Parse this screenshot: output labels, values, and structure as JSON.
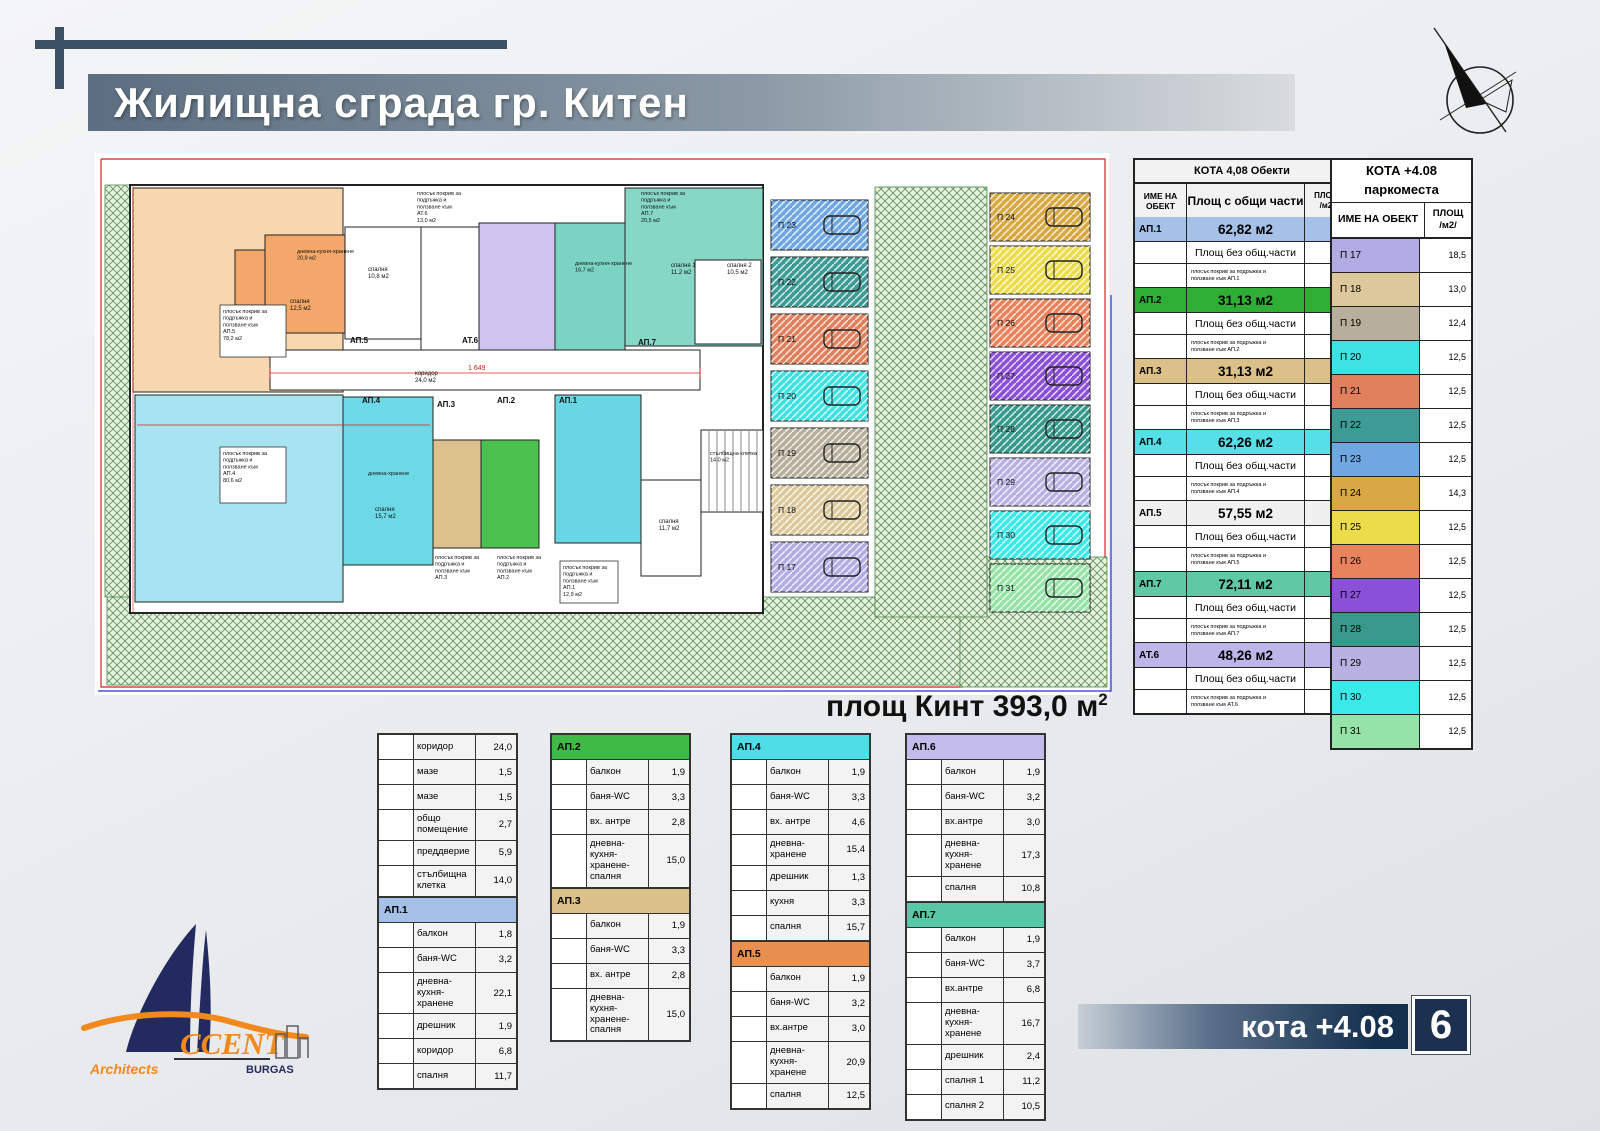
{
  "header": {
    "title": "Жилищна сграда гр. Китен"
  },
  "plot_area": {
    "text": "площ Кинт 393,0 м",
    "sup": "2"
  },
  "footer": {
    "kota": "кота +4.08",
    "sheet": "6"
  },
  "logo": {
    "ccent": "CCENT",
    "architects": "Architects",
    "city": "BURGAS"
  },
  "objects_table": {
    "title": "КОТА 4,08 Обекти",
    "headers": {
      "name": "ИМЕ НА ОБЕКТ",
      "with_common": "Площ с общи части",
      "area1": "ПЛОЩ",
      "area2": "/м2/"
    },
    "net_label": "Площ без общ.части",
    "rows": [
      {
        "name": "АП.1",
        "color": "#a6c1e8",
        "total": "62,82 м2",
        "net": "56,1",
        "roof_note": "плосък покрив за подръжка и\nползване към АП.1",
        "roof": "12,9"
      },
      {
        "name": "АП.2",
        "color": "#2fae35",
        "total": "31,13 м2",
        "net": "27,8",
        "roof_note": "плосък покрив за подръжка и\nползване към  АП.2",
        "roof": "6,2"
      },
      {
        "name": "АП.3",
        "color": "#dcc08a",
        "total": "31,13 м2",
        "net": "27,8",
        "roof_note": "плосък покрив за подръжка и\nползване към  АП.3",
        "roof": "6,2"
      },
      {
        "name": "АП.4",
        "color": "#57dfe8",
        "total": "62,26 м2",
        "net": "55,6",
        "roof_note": "плосък покрив за подръжка и\nползване към  АП.4",
        "roof": "80,6"
      },
      {
        "name": "АП.5",
        "color": "#f0f0f0",
        "total": "57,55 м2",
        "net": "51,4",
        "roof_note": "плосък покрив за подръжка и\nползване към  АП.5",
        "roof": "79,2"
      },
      {
        "name": "АП.7",
        "color": "#5fc9a5",
        "total": "72,11 м2",
        "net": "64,4",
        "roof_note": "плосък покрив за подръжка и\nползване към  АП.7",
        "roof": "20,5"
      },
      {
        "name": "АТ.6",
        "color": "#beb5e8",
        "total": "48,26 м2",
        "net": "43,1",
        "roof_note": "плосък покрив за подръжка и\nползване към  АТ.6",
        "roof": "13,0"
      }
    ]
  },
  "parking_table": {
    "title_line1": "КОТА +4.08",
    "title_line2": "паркоместа",
    "headers": {
      "name": "ИМЕ НА ОБЕКТ",
      "area1": "ПЛОЩ",
      "area2": "/м2/"
    },
    "rows": [
      {
        "name": "П 17",
        "area": "18,5",
        "color": "#b3abe4"
      },
      {
        "name": "П 18",
        "area": "13,0",
        "color": "#ddc89c"
      },
      {
        "name": "П 19",
        "area": "12,4",
        "color": "#b7af9b"
      },
      {
        "name": "П 20",
        "area": "12,5",
        "color": "#3fe2e2"
      },
      {
        "name": "П 21",
        "area": "12,5",
        "color": "#e0805c"
      },
      {
        "name": "П 22",
        "area": "12,5",
        "color": "#3c9b95"
      },
      {
        "name": "П 23",
        "area": "12,5",
        "color": "#6fa7e2"
      },
      {
        "name": "П 24",
        "area": "14,3",
        "color": "#d8a842"
      },
      {
        "name": "П 25",
        "area": "12,5",
        "color": "#ecdc4c"
      },
      {
        "name": "П 26",
        "area": "12,5",
        "color": "#e8835d"
      },
      {
        "name": "П 27",
        "area": "12,5",
        "color": "#8b50d8"
      },
      {
        "name": "П 28",
        "area": "12,5",
        "color": "#37998c"
      },
      {
        "name": "П 29",
        "area": "12,5",
        "color": "#b9b1e2"
      },
      {
        "name": "П 30",
        "area": "12,5",
        "color": "#3ce9e9"
      },
      {
        "name": "П 31",
        "area": "12,5",
        "color": "#96e3a7"
      }
    ]
  },
  "room_tables": [
    {
      "blocks": [
        {
          "header": null,
          "color": null,
          "rows": [
            [
              "коридор",
              "24,0"
            ],
            [
              "мазе",
              "1,5"
            ],
            [
              "мазе",
              "1,5"
            ],
            [
              "общо помещение",
              "2,7"
            ],
            [
              "преддверие",
              "5,9"
            ],
            [
              "стълбищна клетка",
              "14,0"
            ]
          ]
        },
        {
          "header": "АП.1",
          "color": "#a6c1e8",
          "rows": [
            [
              "балкон",
              "1,8"
            ],
            [
              "баня-WC",
              "3,2"
            ],
            [
              "дневна-кухня-хранене",
              "22,1"
            ],
            [
              "дрешник",
              "1,9"
            ],
            [
              "коридор",
              "6,8"
            ],
            [
              "спалня",
              "11,7"
            ]
          ]
        }
      ]
    },
    {
      "blocks": [
        {
          "header": "АП.2",
          "color": "#3fbb45",
          "rows": [
            [
              "балкон",
              "1,9"
            ],
            [
              "баня-WC",
              "3,3"
            ],
            [
              "вх. антре",
              "2,8"
            ],
            [
              "дневна-кухня-хранене-спалня",
              "15,0"
            ]
          ]
        },
        {
          "header": "АП.3",
          "color": "#dcc08a",
          "rows": [
            [
              "балкон",
              "1,9"
            ],
            [
              "баня-WC",
              "3,3"
            ],
            [
              "вх. антре",
              "2,8"
            ],
            [
              "дневна-кухня-хранене-спалня",
              "15,0"
            ]
          ]
        }
      ]
    },
    {
      "blocks": [
        {
          "header": "АП.4",
          "color": "#4fdde8",
          "rows": [
            [
              "балкон",
              "1,9"
            ],
            [
              "баня-WC",
              "3,3"
            ],
            [
              "вх. антре",
              "4,6"
            ],
            [
              "дневна-хранене",
              "15,4"
            ],
            [
              "дрешник",
              "1,3"
            ],
            [
              "кухня",
              "3,3"
            ],
            [
              "спалня",
              "15,7"
            ]
          ]
        },
        {
          "header": "АП.5",
          "color": "#e89050",
          "rows": [
            [
              "балкон",
              "1,9"
            ],
            [
              "баня-WC",
              "3,2"
            ],
            [
              "вх.антре",
              "3,0"
            ],
            [
              "дневна-кухня-хранене",
              "20,9"
            ],
            [
              "спалня",
              "12,5"
            ]
          ]
        }
      ]
    },
    {
      "blocks": [
        {
          "header": "АП.6",
          "color": "#c3bbe9",
          "rows": [
            [
              "балкон",
              "1,9"
            ],
            [
              "баня-WC",
              "3,2"
            ],
            [
              "вх.антре",
              "3,0"
            ],
            [
              "дневна-кухня-хранене",
              "17,3"
            ],
            [
              "спалня",
              "10,8"
            ]
          ]
        },
        {
          "header": "АП.7",
          "color": "#57c8a3",
          "rows": [
            [
              "балкон",
              "1,9"
            ],
            [
              "баня-WC",
              "3,7"
            ],
            [
              "вх.антре",
              "6,8"
            ],
            [
              "дневна-кухня-хранене",
              "16,7"
            ],
            [
              "дрешник",
              "2,4"
            ],
            [
              "спалня 1",
              "11,2"
            ],
            [
              "спалня 2",
              "10,5"
            ]
          ]
        }
      ]
    }
  ],
  "plan": {
    "hatch": [
      {
        "x": 22,
        "y": 452,
        "w": 855,
        "h": 88
      },
      {
        "x": 875,
        "y": 412,
        "w": 147,
        "h": 130
      },
      {
        "x": 790,
        "y": 42,
        "w": 112,
        "h": 430
      },
      {
        "x": 20,
        "y": 40,
        "w": 28,
        "h": 412
      }
    ],
    "rooms": [
      {
        "x": 45,
        "y": 40,
        "w": 633,
        "h": 428,
        "f": "#ffffff",
        "sw": 2
      },
      {
        "x": 48,
        "y": 43,
        "w": 210,
        "h": 204,
        "f": "#f8d7ae"
      },
      {
        "x": 180,
        "y": 90,
        "w": 80,
        "h": 98,
        "f": "#f3a768"
      },
      {
        "x": 150,
        "y": 105,
        "w": 30,
        "h": 55,
        "f": "#f3a768"
      },
      {
        "x": 260,
        "y": 82,
        "w": 76,
        "h": 112,
        "f": "#ffffff"
      },
      {
        "x": 336,
        "y": 82,
        "w": 58,
        "h": 124,
        "f": "#ffffff"
      },
      {
        "x": 394,
        "y": 78,
        "w": 76,
        "h": 128,
        "f": "#cdc4ef"
      },
      {
        "x": 470,
        "y": 78,
        "w": 70,
        "h": 128,
        "f": "#7bd3c3"
      },
      {
        "x": 540,
        "y": 43,
        "w": 138,
        "h": 158,
        "f": "#86d7c6"
      },
      {
        "x": 610,
        "y": 115,
        "w": 66,
        "h": 84,
        "f": "#ffffff"
      },
      {
        "x": 185,
        "y": 205,
        "w": 430,
        "h": 40,
        "f": "#ffffff"
      },
      {
        "x": 50,
        "y": 250,
        "w": 208,
        "h": 207,
        "f": "#a8e4f0"
      },
      {
        "x": 258,
        "y": 252,
        "w": 90,
        "h": 168,
        "f": "#6cd9e7"
      },
      {
        "x": 348,
        "y": 295,
        "w": 48,
        "h": 108,
        "f": "#dcc18c"
      },
      {
        "x": 396,
        "y": 295,
        "w": 58,
        "h": 108,
        "f": "#4cc04f"
      },
      {
        "x": 470,
        "y": 250,
        "w": 86,
        "h": 148,
        "f": "#69d6e4"
      },
      {
        "x": 556,
        "y": 335,
        "w": 60,
        "h": 96,
        "f": "#ffffff"
      },
      {
        "x": 616,
        "y": 285,
        "w": 62,
        "h": 82,
        "f": "#ffffff"
      }
    ],
    "parking_left": {
      "x": 686,
      "y": 55,
      "w": 97,
      "h": 50,
      "pitch": 57,
      "stalls": [
        [
          "П 23",
          "#6fa7e2"
        ],
        [
          "П 22",
          "#3c9b95"
        ],
        [
          "П 21",
          "#e0805c"
        ],
        [
          "П 20",
          "#3fe2e2"
        ],
        [
          "П 19",
          "#b7af9b"
        ],
        [
          "П 18",
          "#ddc89c"
        ],
        [
          "П 17",
          "#b3abe4"
        ]
      ]
    },
    "parking_right": {
      "x": 905,
      "y": 48,
      "w": 100,
      "h": 48,
      "pitch": 53,
      "stalls": [
        [
          "П 24",
          "#d8a842"
        ],
        [
          "П 25",
          "#ecdc4c"
        ],
        [
          "П 26",
          "#e8835d"
        ],
        [
          "П 27",
          "#8b50d8"
        ],
        [
          "П 28",
          "#37998c"
        ],
        [
          "П 29",
          "#b9b1e2"
        ],
        [
          "П 30",
          "#3ce9e9"
        ],
        [
          "П 31",
          "#96e3a7"
        ]
      ]
    },
    "labels": [
      {
        "x": 138,
        "y": 168,
        "w": 66,
        "h": 52,
        "box": 1,
        "s": 5.5,
        "t": "плосък покрив за\nподръжка и\nползване към\nАП.5\n78,2 м2"
      },
      {
        "x": 138,
        "y": 310,
        "w": 66,
        "h": 56,
        "box": 1,
        "s": 5.5,
        "t": "плосък покрив за\nподръжка и\nползване към\nАП.4\n80,6 м2"
      },
      {
        "x": 332,
        "y": 50,
        "s": 5.5,
        "t": "плосък покрив за\nподръжка и\nползване към\nАТ.6\n13,0 м2"
      },
      {
        "x": 556,
        "y": 50,
        "s": 5.5,
        "t": "плосък покрив за\nподръжка и\nползване към\nАП.7\n20,5 м2"
      },
      {
        "x": 350,
        "y": 414,
        "s": 5.5,
        "t": "плосък покрив за\nподръжка и\nползване към\nАП.3"
      },
      {
        "x": 412,
        "y": 414,
        "s": 5.5,
        "t": "плосък покрив за\nподръжка и\nползване към\nАП.2"
      },
      {
        "x": 478,
        "y": 424,
        "w": 58,
        "h": 42,
        "box": 1,
        "s": 5.5,
        "t": "плосък покрив за\nподръжка и\nползване към\nАП.1\n12,9 м2"
      },
      {
        "x": 265,
        "y": 198,
        "b": 1,
        "s": 8,
        "t": "АП.5"
      },
      {
        "x": 377,
        "y": 198,
        "b": 1,
        "s": 8,
        "t": "АТ.6"
      },
      {
        "x": 553,
        "y": 200,
        "b": 1,
        "s": 8,
        "t": "АП.7"
      },
      {
        "x": 277,
        "y": 258,
        "b": 1,
        "s": 8,
        "t": "АП.4"
      },
      {
        "x": 352,
        "y": 262,
        "b": 1,
        "s": 8,
        "t": "АП.3"
      },
      {
        "x": 412,
        "y": 258,
        "b": 1,
        "s": 8,
        "t": "АП.2"
      },
      {
        "x": 474,
        "y": 258,
        "b": 1,
        "s": 8,
        "t": "АП.1"
      },
      {
        "x": 330,
        "y": 230,
        "s": 6,
        "t": "коридор\n24,0 м2"
      },
      {
        "x": 205,
        "y": 158,
        "s": 6,
        "t": "спалня\n12,5 м2"
      },
      {
        "x": 212,
        "y": 108,
        "s": 5.5,
        "t": "дневна-кухня-хранене\n20,9 м2"
      },
      {
        "x": 283,
        "y": 126,
        "s": 6,
        "t": "спалня\n10,8 м2"
      },
      {
        "x": 490,
        "y": 120,
        "s": 5.5,
        "t": "дневна-кухня-хранене\n16,7 м2"
      },
      {
        "x": 586,
        "y": 122,
        "s": 6,
        "t": "спалня 1\n11,2 м2"
      },
      {
        "x": 642,
        "y": 122,
        "s": 6,
        "t": "спалня 2\n10,5 м2"
      },
      {
        "x": 283,
        "y": 330,
        "s": 5.5,
        "t": "дневна-хранене"
      },
      {
        "x": 290,
        "y": 366,
        "s": 6,
        "t": "спалня\n15,7 м2"
      },
      {
        "x": 625,
        "y": 310,
        "s": 5.5,
        "t": "стълбищна клетка\n14,0 м2"
      },
      {
        "x": 574,
        "y": 378,
        "s": 6,
        "t": "спалня\n11,7 м2"
      },
      {
        "x": 383,
        "y": 225,
        "s": 7,
        "c": "#d02020",
        "t": "1 649"
      }
    ]
  }
}
